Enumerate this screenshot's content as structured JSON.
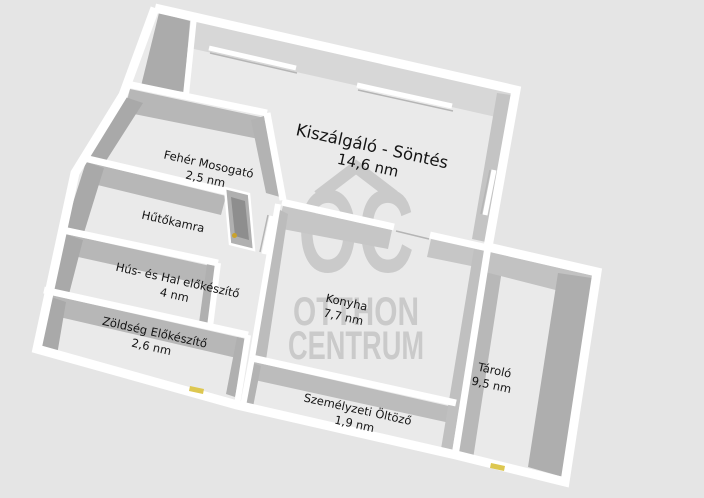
{
  "floor_plan": {
    "rooms": [
      {
        "name": "Kiszálgáló - Söntés",
        "area": "14,6 nm"
      },
      {
        "name": "Fehér Mosogató",
        "area": "2,5 nm"
      },
      {
        "name": "Hűtőkamra",
        "area": ""
      },
      {
        "name": "Hús- és Hal előkészítő",
        "area": "4 nm"
      },
      {
        "name": "Zöldség Előkészítő",
        "area": "2,6 nm"
      },
      {
        "name": "Konyha",
        "area": "7,7 nm"
      },
      {
        "name": "Személyzeti Öltöző",
        "area": "1,9 nm"
      },
      {
        "name": "Tároló",
        "area": "9,5 nm"
      }
    ],
    "watermark": {
      "logo": "OC",
      "line1": "OTTHON",
      "line2": "CENTRUM"
    },
    "colors": {
      "background": "#e5e5e5",
      "floor": "#eaeaea",
      "wall": "#ffffff",
      "wall_face": "#b0b0b0",
      "watermark": "#c7c7c7",
      "door_marker": "#ddc750",
      "door_handle": "#c9a22c"
    }
  }
}
